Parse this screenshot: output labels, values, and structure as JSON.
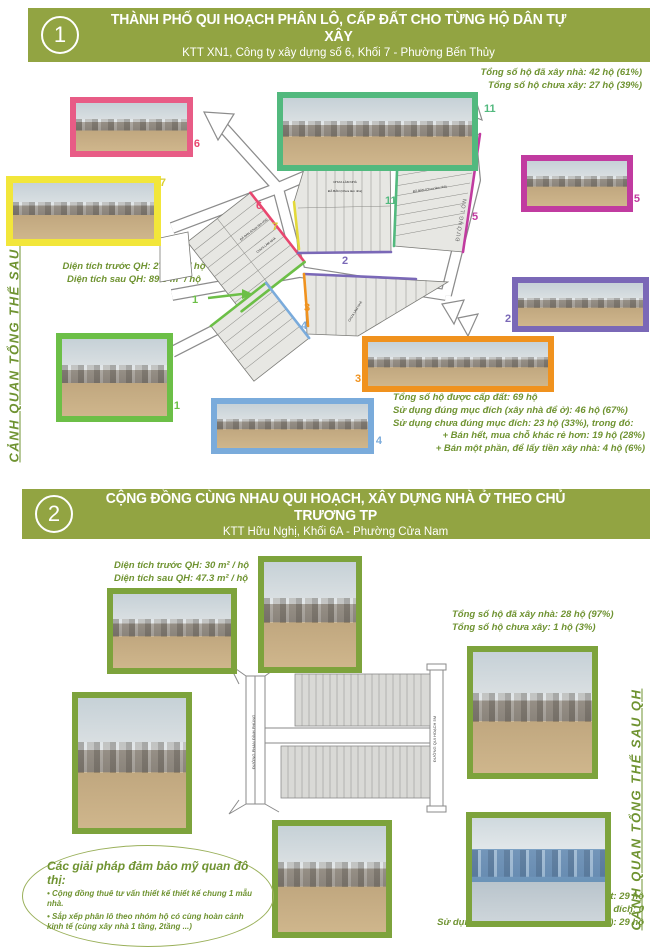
{
  "poster": {
    "bg": "#ffffff",
    "accent": "#92a442",
    "stat_color": "#6f9331"
  },
  "section1": {
    "number": "1",
    "title": "THÀNH PHỐ QUI HOẠCH PHÂN LÔ, CẤP ĐẤT CHO TỪNG HỘ DÂN TỰ XÂY",
    "subtitle": "KTT XN1, Công ty xây dựng số 6, Khối 7 - Phường Bến Thủy",
    "side_label": "CẢNH QUAN TỔNG THỂ SAU QH",
    "stats_built": {
      "line1": "Tổng số hộ đã xây nhà: 42 hộ (61%)",
      "line2": "Tổng số hộ chưa xây: 27 hộ (39%)"
    },
    "stats_area": {
      "line1": "Diện tích trước QH: 27.9 m² / hộ",
      "line2": "Diện tích sau QH: 89.3 m² / hộ"
    },
    "stats_usage": {
      "line1": "Tổng số hộ được cấp đất: 69 hộ",
      "line2": "Sử dụng đúng mục đích (xây nhà để ở): 46 hộ (67%)",
      "line3": "Sử dụng chưa đúng mục đích: 23 hộ (33%), trong đó:",
      "line4": "+ Bán hết, mua chỗ khác rẻ hơn: 19 hộ (28%)",
      "line5": "+ Bán một phần, để lấy tiền xây nhà: 4 hộ (6%)"
    },
    "map": {
      "street_label": "ĐƯỜNG LỚN",
      "lot_sold": "ĐÃ BÁN (Chưa làm nhà)",
      "lot_not_built": "CHƯA LÀM NHÀ",
      "markers": {
        "m6": "6",
        "m7": "7",
        "m11": "11",
        "m11b": "11",
        "m5": "5",
        "m2": "2",
        "m1": "1",
        "m3": "3",
        "m4": "4"
      },
      "marker_colors": {
        "m6": "#e8476f",
        "m7": "#d9ce35",
        "m11": "#52b97e",
        "m5": "#c13ba0",
        "m2": "#7a68b7",
        "m1": "#6cbf47",
        "m3": "#f0921e",
        "m4": "#7aabdb"
      }
    },
    "photos": {
      "p6": "6",
      "p7": "7",
      "p11": "11",
      "p5": "5",
      "p2": "2",
      "p1": "1",
      "p3": "3",
      "p4": "4"
    }
  },
  "section2": {
    "number": "2",
    "title": "CỘNG ĐỒNG CÙNG NHAU QUI HOẠCH, XÂY DỰNG NHÀ Ở THEO CHỦ TRƯƠNG TP",
    "subtitle": "KTT Hữu Nghị, Khối 6A - Phường Cửa Nam",
    "side_label": "CẢNH QUAN TỔNG THỂ SAU QH",
    "stats_area": {
      "line1": "Diện tích trước QH: 30 m² / hộ",
      "line2": "Diện tích sau QH: 47.3 m² / hộ"
    },
    "stats_built": {
      "line1": "Tổng số hộ đã xây nhà: 28 hộ (97%)",
      "line2": "Tổng số hộ chưa xây: 1 hộ (3%)"
    },
    "stats_usage": {
      "line1": "Tổng số hộ được cấp đất: 29 hộ",
      "line2": "Sử dụng chưa đúng mục đích: 0",
      "line3": "Sử dụng đúng mục đích (xây nhà để ở): 29 hộ"
    },
    "callout": {
      "title": "Các giải pháp đảm bảo mỹ quan đô thị:",
      "bullet1": "Cộng đồng thuê tư vấn thiết kế thiết kế chung 1 mẫu nhà.",
      "bullet2": "Sắp xếp phân lô theo nhóm hộ có cùng hoàn cảnh kinh tế (cùng xây nhà 1 tầng, 2tầng ...)"
    },
    "diagram": {
      "left_road": "ĐƯỜNG PHAN ĐÌNH PHÙNG",
      "right_road": "ĐƯỜNG QUI HOẠCH 5M"
    }
  }
}
